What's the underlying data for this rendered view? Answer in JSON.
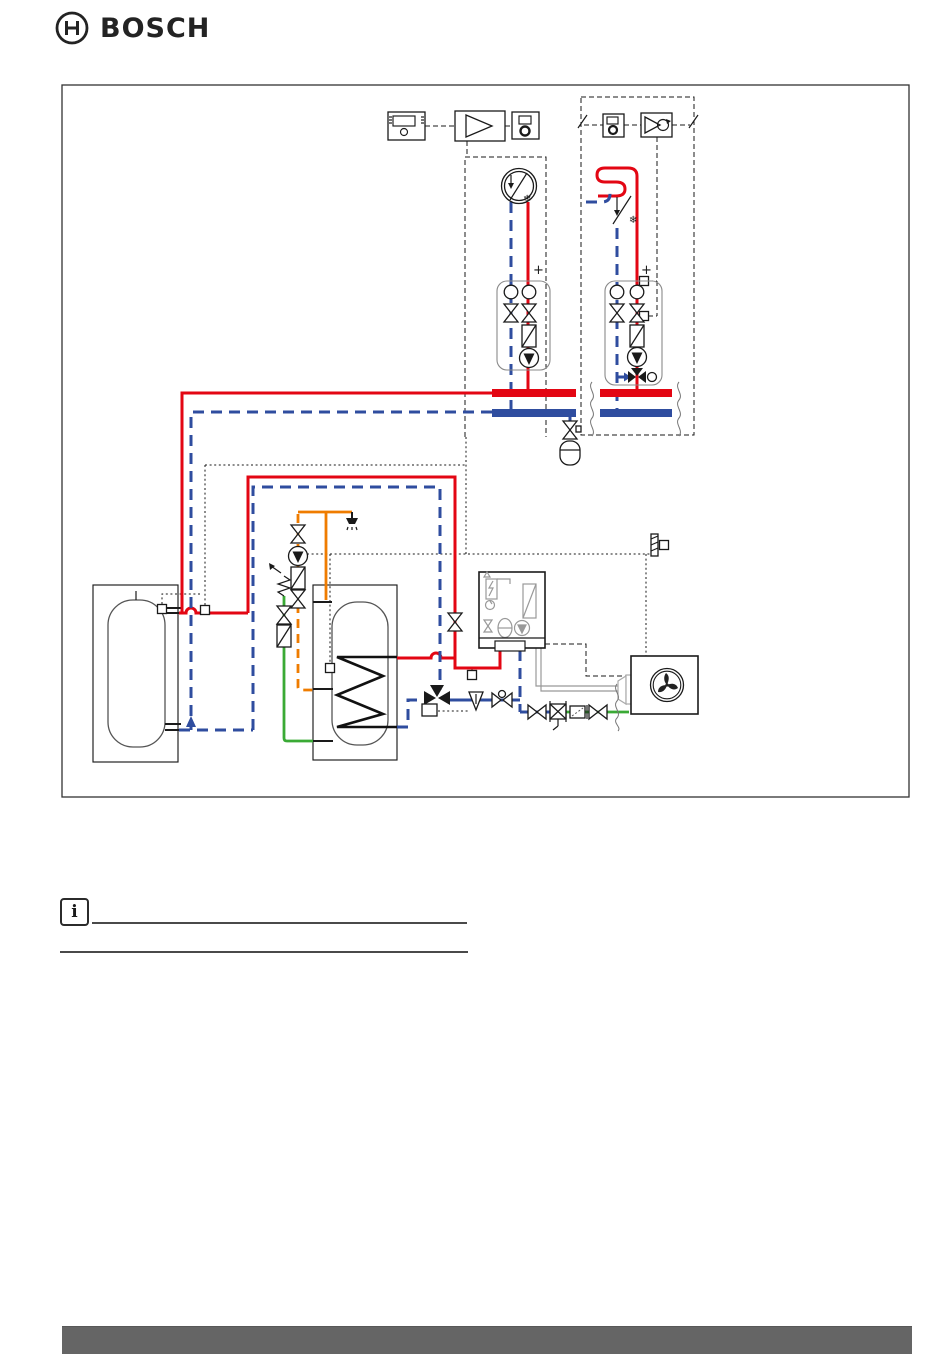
{
  "header": {
    "logo_text": "BOSCH",
    "logo_icon": "bosch-armature-icon"
  },
  "note": {
    "icon_glyph": "i"
  },
  "diagram": {
    "kind": "heat-pump-hydraulic-scheme",
    "glyphs": {
      "cooling_left": "❄",
      "cooling_right": "❄",
      "plus_left": "+",
      "plus_right": "+"
    },
    "colors": {
      "supply_pipe": "#e30613",
      "return_pipe": "#2f4d9f",
      "dhw_circulation_pipe": "#ef7c00",
      "cold_water_pipe": "#3aaa35",
      "refrigerant_line": "#ababab",
      "control_line": "#1a1a1a",
      "footer_bar": "#656565"
    },
    "symbols": [
      "room-controller",
      "control-module",
      "system-module",
      "mixer-module",
      "fan-coil-unit",
      "underfloor-heating-circuit",
      "pump-station-direct-circuit",
      "pump-station-mixed-circuit",
      "manifold-headers",
      "expansion-vessel",
      "buffer-cylinder",
      "dhw-cylinder-with-coil",
      "dhw-circulation-pump",
      "safety-group",
      "shower-outlet",
      "cold-water-inlet",
      "heat-pump-indoor-unit",
      "heat-pump-outdoor-unit",
      "outdoor-temperature-sensor",
      "three-way-diverter-valve",
      "particle-filter",
      "shut-off-valve",
      "strainer",
      "temperature-sensor"
    ]
  }
}
